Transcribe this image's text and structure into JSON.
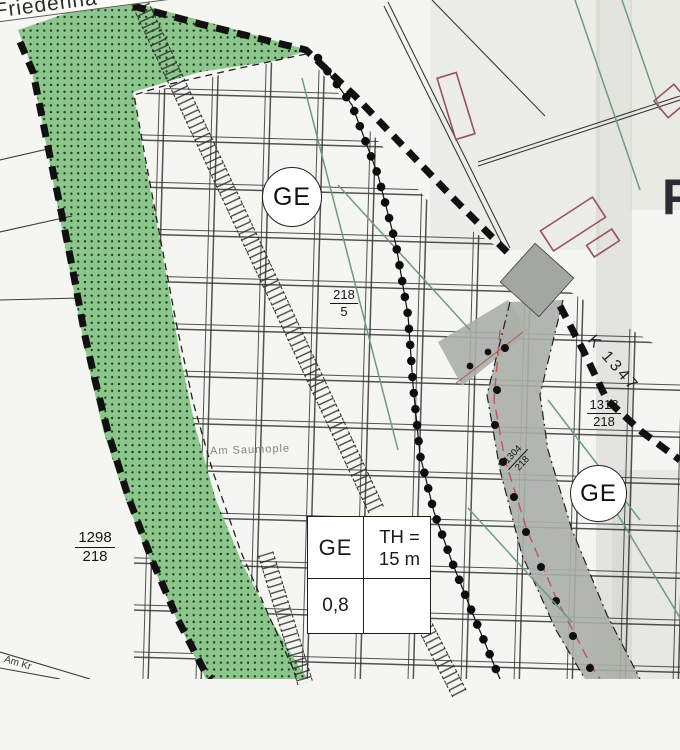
{
  "streets": {
    "top": "Friedenha",
    "bottom_left": "Am Kr",
    "road_label": "K 1347",
    "field_name": "Am Saumople"
  },
  "zones": {
    "left_circle": "GE",
    "right_circle": "GE"
  },
  "edge_letter": "P",
  "parcels": [
    {
      "num": "218",
      "den": "5"
    },
    {
      "num": "1298",
      "den": "218"
    },
    {
      "num": "1318",
      "den": "218"
    },
    {
      "num": "1304",
      "den": "218"
    }
  ],
  "info_box": {
    "use": "GE",
    "th_label": "TH =",
    "th_value": "15 m",
    "grz": "0,8"
  },
  "colors": {
    "green_area": "#8cc68c",
    "road_gray": "#abafa9",
    "boundary_black": "#111111",
    "building_outline": "#95525b",
    "contour_green": "#6f9b7d",
    "centerline_red": "#c05555"
  }
}
